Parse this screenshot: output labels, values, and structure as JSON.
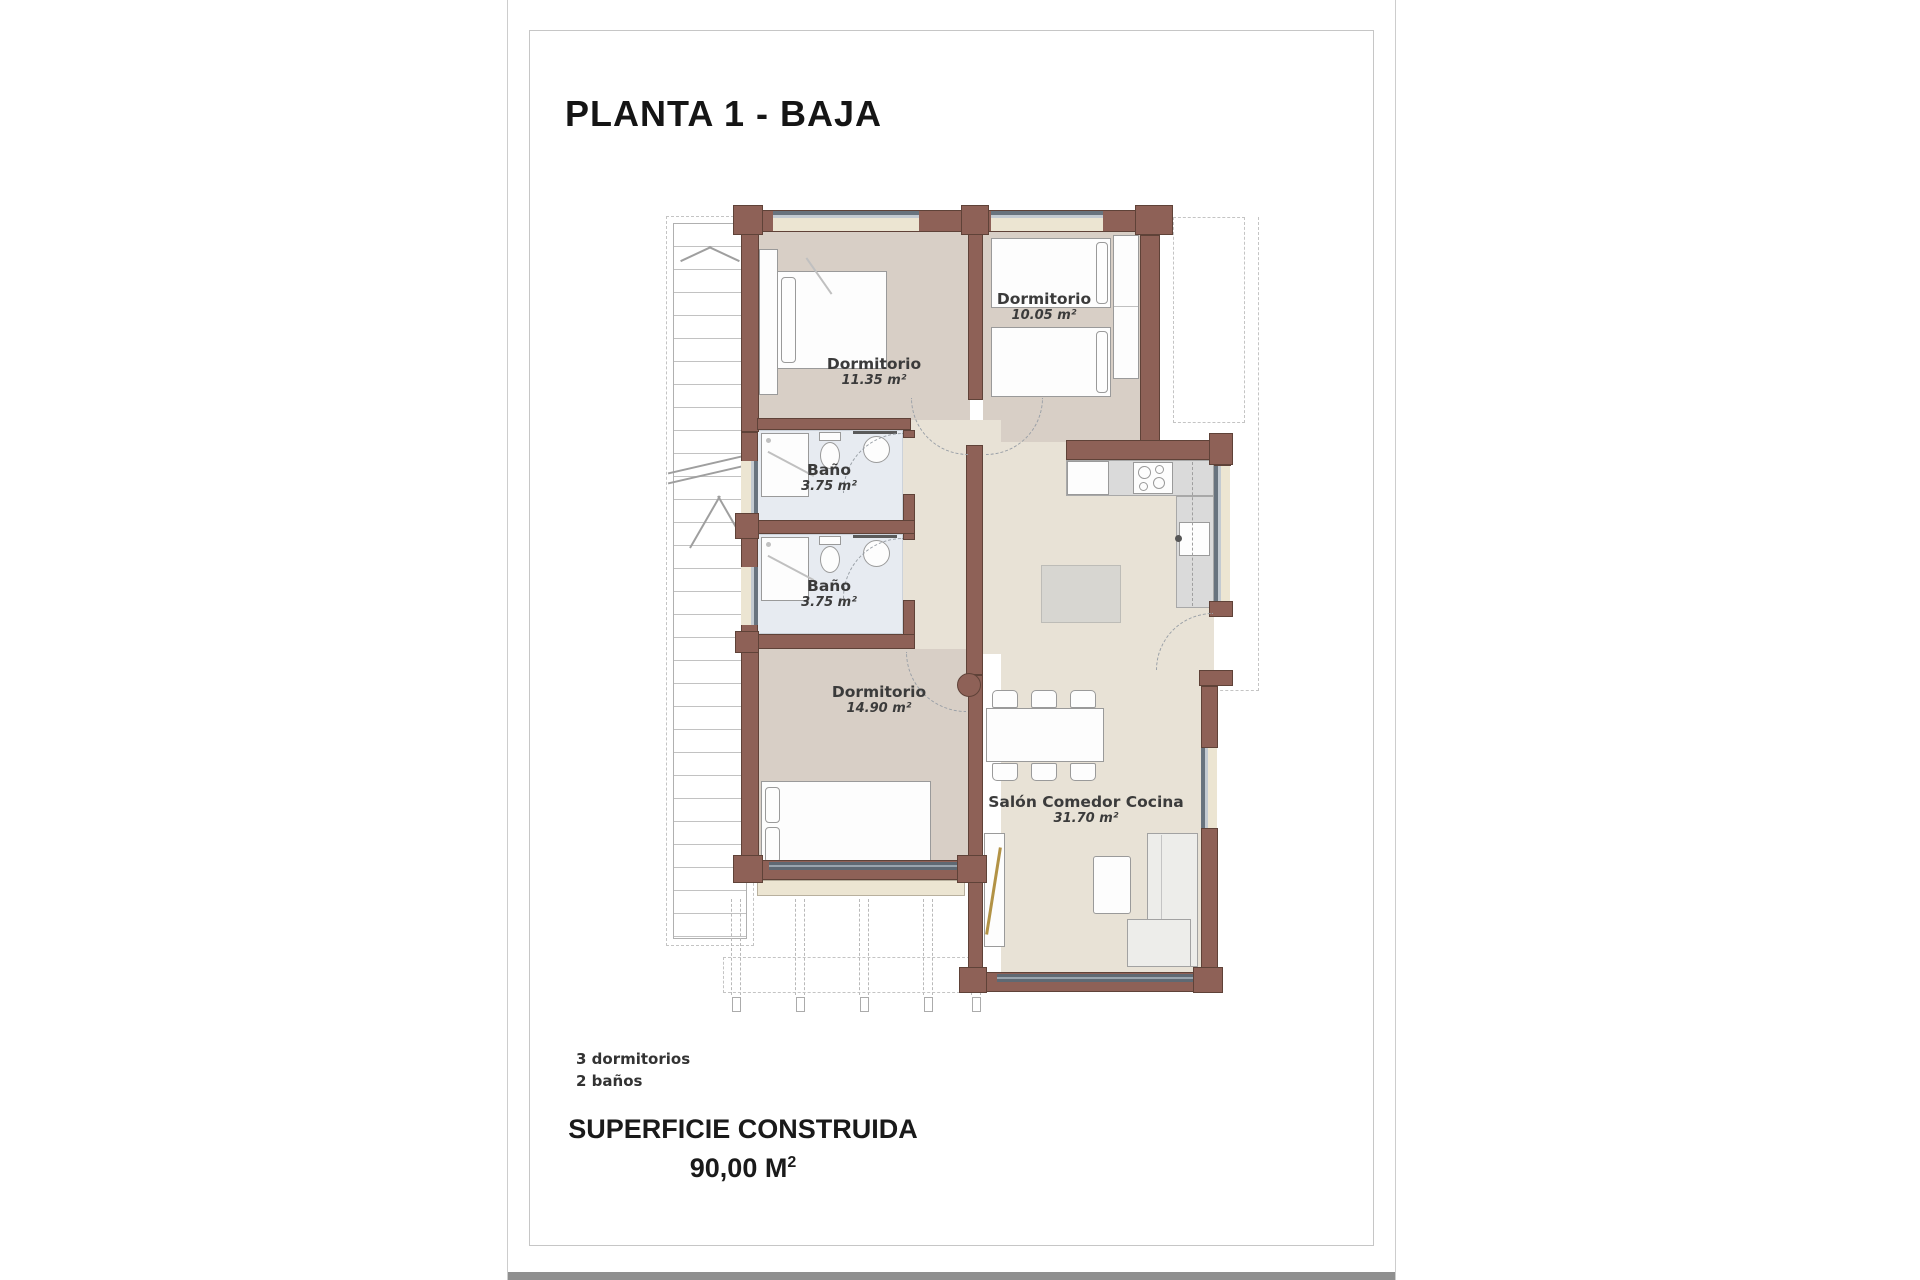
{
  "title": "PLANTA 1 - BAJA",
  "plan": {
    "rooms": {
      "dormitorio_1": {
        "name": "Dormitorio",
        "area": "11.35 m²"
      },
      "dormitorio_2": {
        "name": "Dormitorio",
        "area": "10.05 m²"
      },
      "bano_1": {
        "name": "Baño",
        "area": "3.75 m²"
      },
      "bano_2": {
        "name": "Baño",
        "area": "3.75 m²"
      },
      "dormitorio_3": {
        "name": "Dormitorio",
        "area": "14.90 m²"
      },
      "salon": {
        "name": "Salón Comedor Cocina",
        "area": "31.70 m²"
      }
    }
  },
  "summary": {
    "dormitorios": "3 dormitorios",
    "banos": "2 baños"
  },
  "footer": {
    "label": "SUPERFICIE CONSTRUIDA",
    "value": "90,00 M",
    "sup": "2"
  },
  "colors": {
    "wall": "#8e6157",
    "wall_border": "#5f4238",
    "floor_bedroom": "#d8cfc6",
    "floor_living": "#e8e2d6",
    "floor_bath": "#e7ebf1",
    "window_sill": "#ece5d2",
    "glazing_dark": "#68737e",
    "glazing_light": "#c3cad1",
    "counter": "#dadada",
    "furniture_border": "#9a9a9a",
    "accent_gold": "#b29245",
    "page_bar": "#8f8f8f"
  }
}
